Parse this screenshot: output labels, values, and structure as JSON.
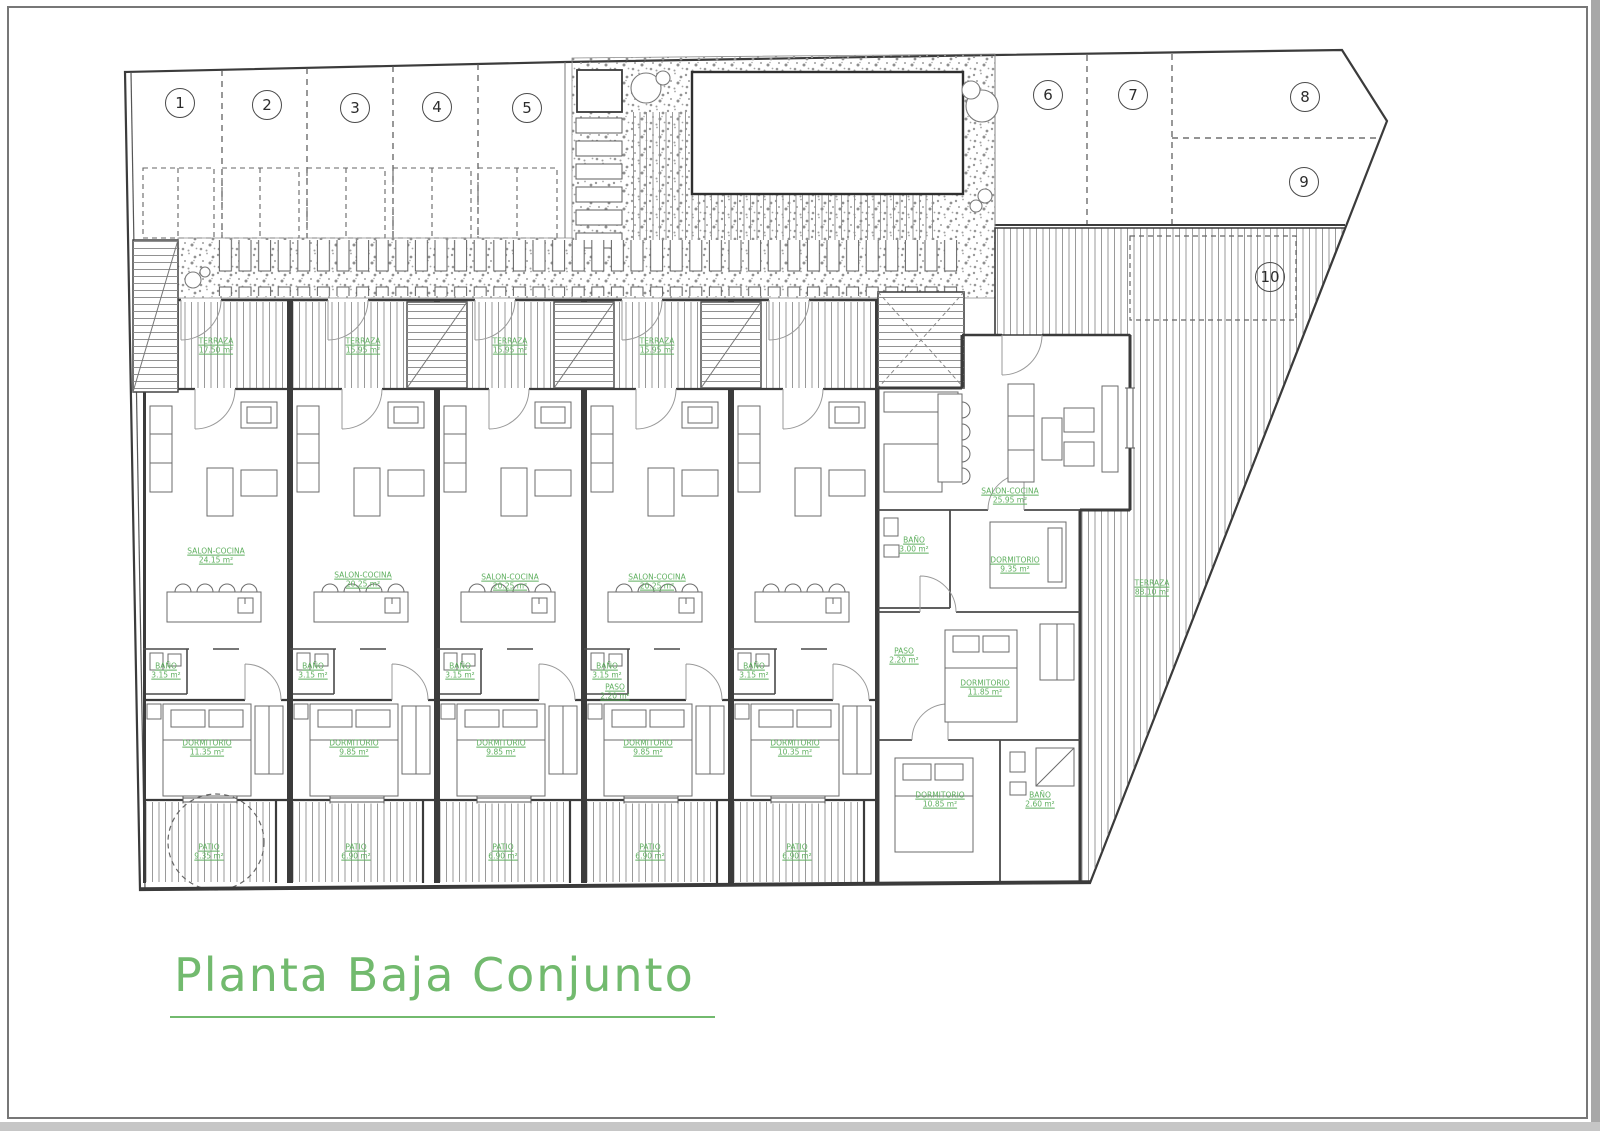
{
  "sheet": {
    "title": "Planta Baja Conjunto"
  },
  "colors": {
    "label_green": "#5FAF5F",
    "title_green": "#72BA6E",
    "wall": "#3B3B3B"
  },
  "parking_badges": [
    {
      "n": "1",
      "x": 180,
      "y": 103
    },
    {
      "n": "2",
      "x": 267,
      "y": 105
    },
    {
      "n": "3",
      "x": 355,
      "y": 108
    },
    {
      "n": "4",
      "x": 437,
      "y": 107
    },
    {
      "n": "5",
      "x": 527,
      "y": 108
    },
    {
      "n": "6",
      "x": 1048,
      "y": 95
    },
    {
      "n": "7",
      "x": 1133,
      "y": 95
    },
    {
      "n": "8",
      "x": 1305,
      "y": 97
    },
    {
      "n": "9",
      "x": 1304,
      "y": 182
    },
    {
      "n": "10",
      "x": 1270,
      "y": 277
    }
  ],
  "room_labels": [
    {
      "name": "TERRAZA",
      "area": "17.50 m²",
      "x": 216,
      "y": 346
    },
    {
      "name": "TERRAZA",
      "area": "15.95 m²",
      "x": 363,
      "y": 346
    },
    {
      "name": "TERRAZA",
      "area": "15.95 m²",
      "x": 510,
      "y": 346
    },
    {
      "name": "TERRAZA",
      "area": "15.95 m²",
      "x": 657,
      "y": 346
    },
    {
      "name": "SALON-COCINA",
      "area": "24.15 m²",
      "x": 216,
      "y": 556
    },
    {
      "name": "SALON-COCINA",
      "area": "20.25 m²",
      "x": 363,
      "y": 580
    },
    {
      "name": "SALON-COCINA",
      "area": "20.25 m²",
      "x": 510,
      "y": 582
    },
    {
      "name": "SALON-COCINA",
      "area": "20.25 m²",
      "x": 657,
      "y": 582
    },
    {
      "name": "SALON-COCINA",
      "area": "25.95 m²",
      "x": 1010,
      "y": 496
    },
    {
      "name": "DORMITORIO",
      "area": "11.35 m²",
      "x": 207,
      "y": 748
    },
    {
      "name": "DORMITORIO",
      "area": "9.85 m²",
      "x": 354,
      "y": 748
    },
    {
      "name": "DORMITORIO",
      "area": "9.85 m²",
      "x": 501,
      "y": 748
    },
    {
      "name": "DORMITORIO",
      "area": "9.85 m²",
      "x": 648,
      "y": 748
    },
    {
      "name": "DORMITORIO",
      "area": "10.35 m²",
      "x": 795,
      "y": 748
    },
    {
      "name": "DORMITORIO",
      "area": "9.35 m²",
      "x": 1015,
      "y": 565
    },
    {
      "name": "DORMITORIO",
      "area": "11.85 m²",
      "x": 985,
      "y": 688
    },
    {
      "name": "DORMITORIO",
      "area": "10.85 m²",
      "x": 940,
      "y": 800
    },
    {
      "name": "BAÑO",
      "area": "3.15 m²",
      "x": 166,
      "y": 671
    },
    {
      "name": "BAÑO",
      "area": "3.15 m²",
      "x": 313,
      "y": 671
    },
    {
      "name": "BAÑO",
      "area": "3.15 m²",
      "x": 460,
      "y": 671
    },
    {
      "name": "BAÑO",
      "area": "3.15 m²",
      "x": 607,
      "y": 671
    },
    {
      "name": "BAÑO",
      "area": "3.15 m²",
      "x": 754,
      "y": 671
    },
    {
      "name": "BAÑO",
      "area": "3.00 m²",
      "x": 914,
      "y": 545
    },
    {
      "name": "BAÑO",
      "area": "2.60 m²",
      "x": 1040,
      "y": 800
    },
    {
      "name": "PASO",
      "area": "2.20 m²",
      "x": 615,
      "y": 692
    },
    {
      "name": "PASO",
      "area": "2.20 m²",
      "x": 904,
      "y": 656
    },
    {
      "name": "PATIO",
      "area": "9.35 m²",
      "x": 209,
      "y": 852
    },
    {
      "name": "PATIO",
      "area": "6.90 m²",
      "x": 356,
      "y": 852
    },
    {
      "name": "PATIO",
      "area": "6.90 m²",
      "x": 503,
      "y": 852
    },
    {
      "name": "PATIO",
      "area": "6.90 m²",
      "x": 650,
      "y": 852
    },
    {
      "name": "PATIO",
      "area": "6.90 m²",
      "x": 797,
      "y": 852
    },
    {
      "name": "TERRAZA",
      "area": "88.10 m²",
      "x": 1152,
      "y": 588
    }
  ]
}
